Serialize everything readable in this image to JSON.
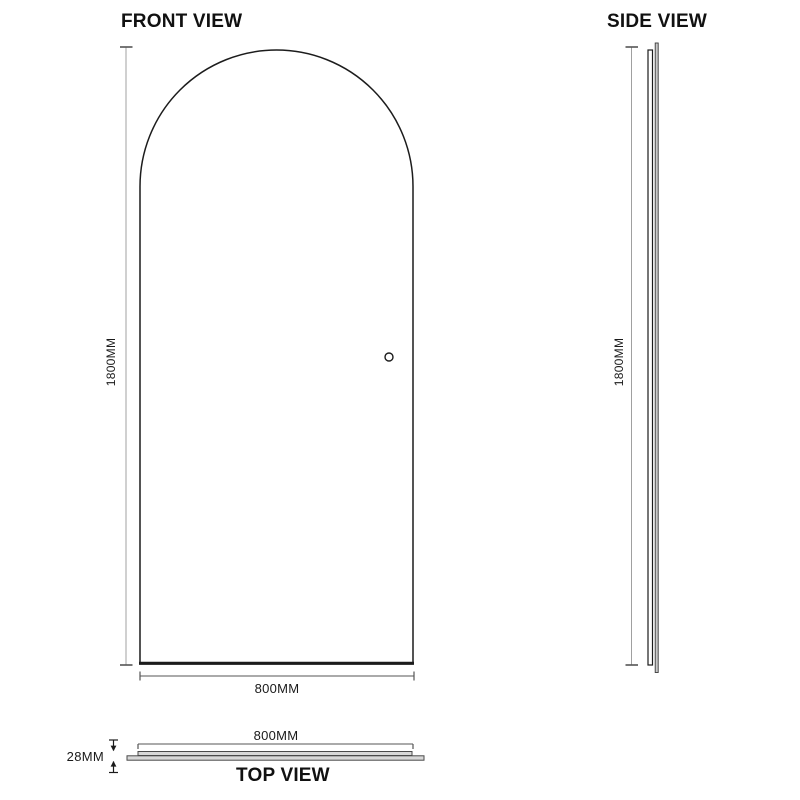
{
  "drawing": {
    "views": {
      "front": {
        "title": "FRONT VIEW",
        "height_label": "1800MM",
        "width_label": "800MM"
      },
      "side": {
        "title": "SIDE VIEW",
        "height_label": "1800MM"
      },
      "top": {
        "title": "TOP VIEW",
        "width_label": "800MM",
        "thickness_label": "28MM"
      }
    },
    "dimensions_mm": {
      "height": 1800,
      "width": 800,
      "thickness": 28
    },
    "shape": "arched-panel-with-knob",
    "colors": {
      "background": "#ffffff",
      "outline": "#1c1c1c",
      "dimension_line": "#a0a0a0",
      "tick": "#555555",
      "bar_fill": "#d8d8d8",
      "text": "#1a1a1a"
    }
  }
}
